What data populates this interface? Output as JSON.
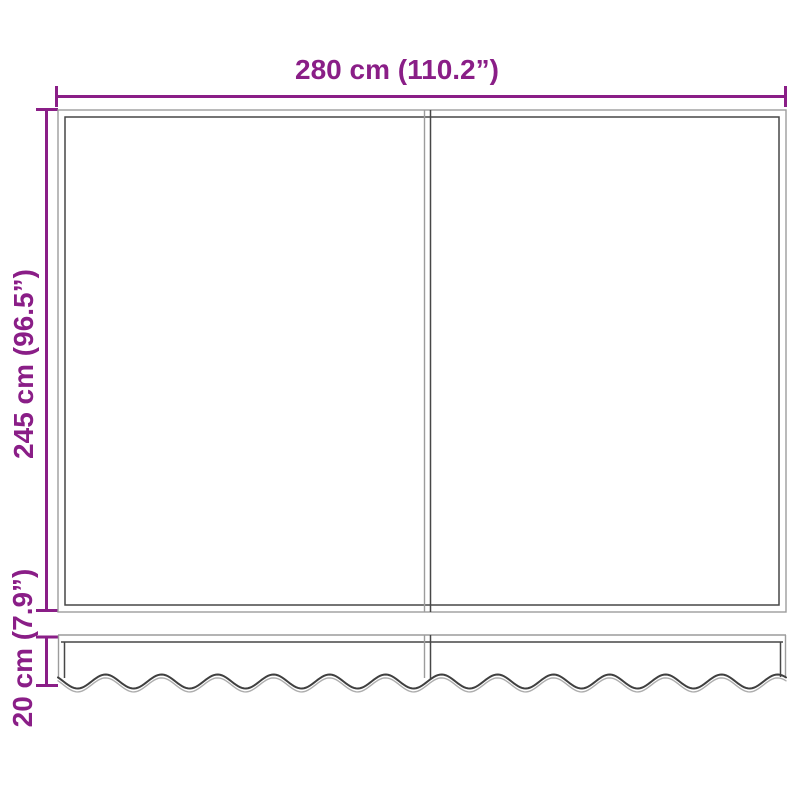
{
  "diagram": {
    "kind": "product-dimension-diagram",
    "labels": {
      "width": "280 cm (110.2”)",
      "height": "245 cm (96.5”)",
      "valance_height": "20 cm (7.9”)"
    },
    "colors": {
      "dimension_accent": "#8A1E87",
      "outline_light": "#9C9C9C",
      "outline_dark": "#474747",
      "wave_light": "#ADADAD",
      "background": "#FFFFFF"
    }
  }
}
